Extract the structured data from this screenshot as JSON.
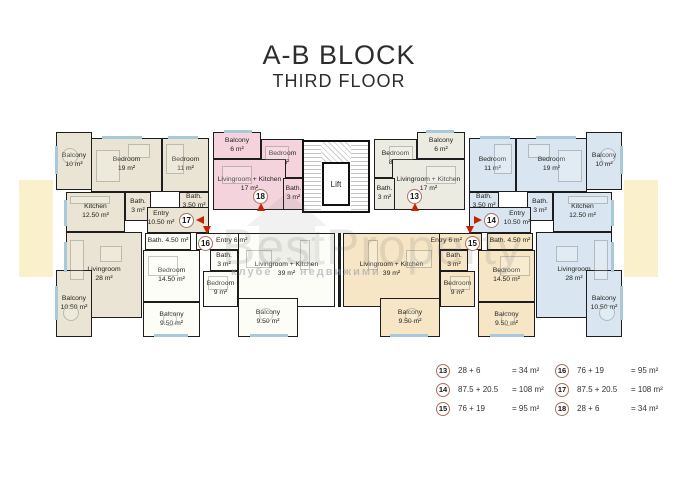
{
  "title": {
    "block": "A-B BLOCK",
    "floor": "THIRD FLOOR"
  },
  "plan": {
    "lift_label": "Lift",
    "apartment_colors": {
      "13": "#ECEBE2",
      "14": "#D9E6F1",
      "15": "#F6E6C5",
      "16": "#FDFDF8",
      "17": "#E9E4D3",
      "18": "#F4D3DD"
    },
    "rooms": [
      {
        "id": "r17_balcony10",
        "apt": "17",
        "label": "Balcony\n10 m²"
      },
      {
        "id": "r17_bed19",
        "apt": "17",
        "label": "Bedroom\n19 m²"
      },
      {
        "id": "r17_bed11",
        "apt": "17",
        "label": "Bedroom\n11 m²"
      },
      {
        "id": "r17_kitchen",
        "apt": "17",
        "label": "Kitchen\n12.50 m²"
      },
      {
        "id": "r17_bath3",
        "apt": "17",
        "label": "Bath.\n3 m²"
      },
      {
        "id": "r17_bath350",
        "apt": "17",
        "label": "Bath.\n3,50 m²"
      },
      {
        "id": "r17_entry",
        "apt": "17",
        "label": "Entry\n10.50 m²"
      },
      {
        "id": "r17_living28",
        "apt": "17",
        "label": "Livingroom\n28 m²"
      },
      {
        "id": "r17_balcony1050",
        "apt": "17",
        "label": "Balcony\n10.50 m²"
      },
      {
        "id": "r18_balcony6",
        "apt": "18",
        "label": "Balcony\n6 m²"
      },
      {
        "id": "r18_bed8",
        "apt": "18",
        "label": "Bedroom\n8 m²"
      },
      {
        "id": "r18_lrk17",
        "apt": "18",
        "label": "Livingroom + Kitchen\n17 m²"
      },
      {
        "id": "r18_bath3",
        "apt": "18",
        "label": "Bath.\n3 m²"
      },
      {
        "id": "r13_balcony6",
        "apt": "13",
        "label": "Balcony\n6 m²"
      },
      {
        "id": "r13_bed8",
        "apt": "13",
        "label": "Bedroom\n8 m²"
      },
      {
        "id": "r13_lrk17",
        "apt": "13",
        "label": "Livingroom + Kitchen\n17 m²"
      },
      {
        "id": "r13_bath3",
        "apt": "13",
        "label": "Bath.\n3 m²"
      },
      {
        "id": "r14_bed11",
        "apt": "14",
        "label": "Bedroom\n11 m²"
      },
      {
        "id": "r14_bed19",
        "apt": "14",
        "label": "Bedroom\n19 m²"
      },
      {
        "id": "r14_balcony10",
        "apt": "14",
        "label": "Balcony\n10 m²"
      },
      {
        "id": "r14_bath350",
        "apt": "14",
        "label": "Bath.\n3.50 m²"
      },
      {
        "id": "r14_bath3",
        "apt": "14",
        "label": "Bath.\n3 m²"
      },
      {
        "id": "r14_kitchen",
        "apt": "14",
        "label": "Kitchen\n12.50 m²"
      },
      {
        "id": "r14_entry",
        "apt": "14",
        "label": "Entry\n10.50 m²"
      },
      {
        "id": "r14_living28",
        "apt": "14",
        "label": "Livingroom\n28 m²"
      },
      {
        "id": "r14_balcony1050",
        "apt": "14",
        "label": "Balcony\n10.50 m²"
      },
      {
        "id": "r16_bath450",
        "apt": "16",
        "label": "Bath. 4.50 m²"
      },
      {
        "id": "r16_entry6",
        "apt": "16",
        "label": "Entry 6 m²"
      },
      {
        "id": "r16_bed1450",
        "apt": "16",
        "label": "Bedroom\n14.50 m²"
      },
      {
        "id": "r16_balcony950",
        "apt": "16",
        "label": "Balcony\n9.50 m²"
      },
      {
        "id": "r16_bath3",
        "apt": "16",
        "label": "Bath.\n3 m²"
      },
      {
        "id": "r16_bed9",
        "apt": "16",
        "label": "Bedroom\n9 m²"
      },
      {
        "id": "r16_lrk39",
        "apt": "16",
        "label": "Livingroom + Kitchen\n39 m²"
      },
      {
        "id": "r16_balcony950c",
        "apt": "16",
        "label": "Balcony\n9.50 m²"
      },
      {
        "id": "r15_entry6",
        "apt": "15",
        "label": "Entry 6 m²"
      },
      {
        "id": "r15_bath450",
        "apt": "15",
        "label": "Bath. 4.50 m²"
      },
      {
        "id": "r15_bed1450",
        "apt": "15",
        "label": "Bedroom\n14.50 m²"
      },
      {
        "id": "r15_balcony950",
        "apt": "15",
        "label": "Balcony\n9.50 m²"
      },
      {
        "id": "r15_bath3",
        "apt": "15",
        "label": "Bath.\n3 m²"
      },
      {
        "id": "r15_bed9",
        "apt": "15",
        "label": "Bedroom\n9 m²"
      },
      {
        "id": "r15_lrk39",
        "apt": "15",
        "label": "Livingroom + Kitchen\n39 m²"
      },
      {
        "id": "r15_balcony950c",
        "apt": "15",
        "label": "Balcony\n9.50 m²"
      }
    ],
    "markers": [
      {
        "unit": "13"
      },
      {
        "unit": "14"
      },
      {
        "unit": "15"
      },
      {
        "unit": "16"
      },
      {
        "unit": "17"
      },
      {
        "unit": "18"
      }
    ]
  },
  "legend": {
    "columns": [
      [
        {
          "unit": "13",
          "formula": "28 + 6",
          "total": "= 34 m²"
        },
        {
          "unit": "14",
          "formula": "87.5 + 20.5",
          "total": "= 108 m²"
        },
        {
          "unit": "15",
          "formula": "76 + 19",
          "total": "= 95 m²"
        }
      ],
      [
        {
          "unit": "16",
          "formula": "76 + 19",
          "total": "= 95 m²"
        },
        {
          "unit": "17",
          "formula": "87.5 + 20.5",
          "total": "= 108 m²"
        },
        {
          "unit": "18",
          "formula": "28 + 6",
          "total": "= 34 m²"
        }
      ]
    ]
  },
  "watermark": {
    "brand": "BestProperty",
    "fragment_left": "клубе",
    "fragment_right": "недвижими"
  }
}
